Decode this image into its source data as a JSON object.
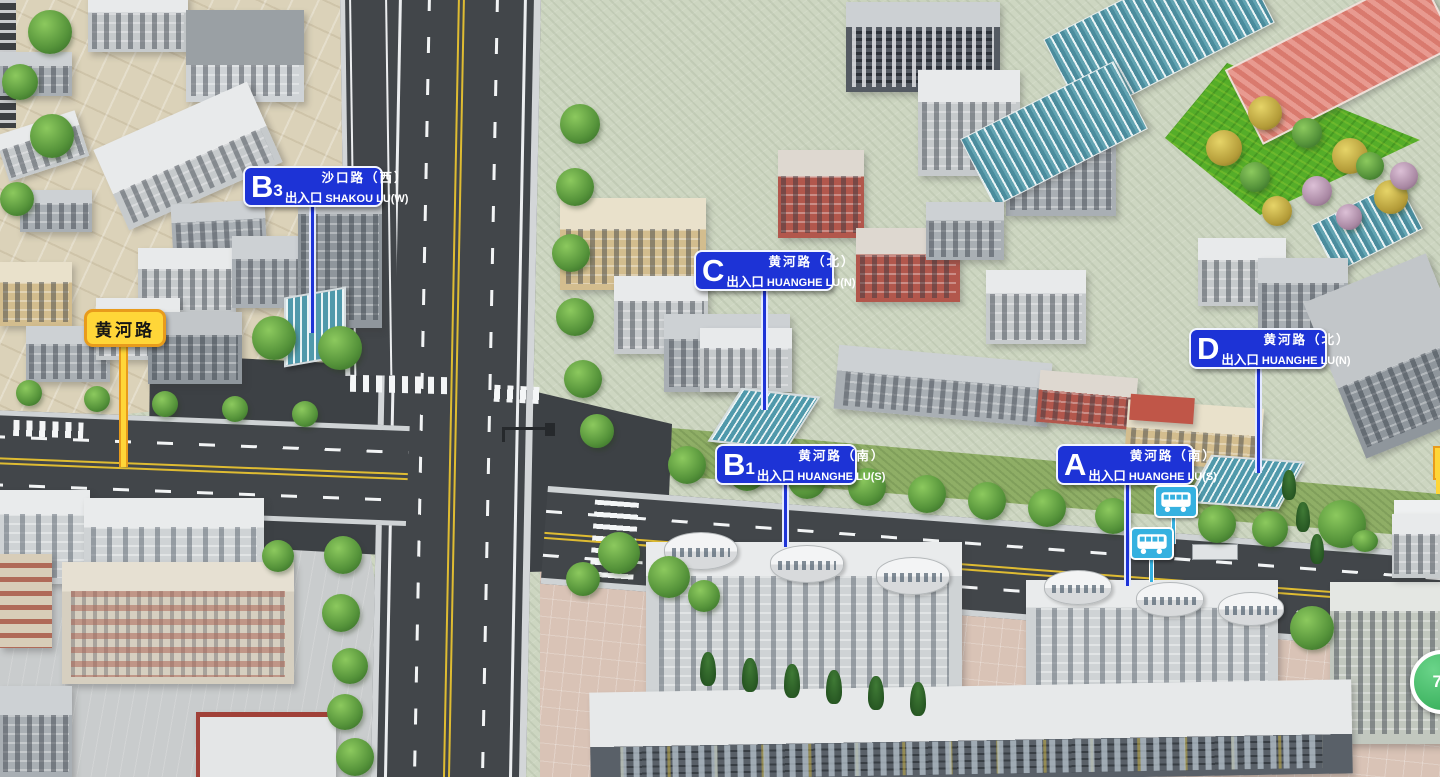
{
  "map_title": "subway-station-exit-3d-map",
  "road_label": {
    "name": "黄河路"
  },
  "exits": [
    {
      "id": "B3",
      "letter": "B",
      "number": "3",
      "road_cn": "沙口路（西）",
      "exit_cn": "出入口",
      "road_en": "SHAKOU LU(W)"
    },
    {
      "id": "C",
      "letter": "C",
      "number": "",
      "road_cn": "黄河路（北）",
      "exit_cn": "出入口",
      "road_en": "HUANGHE LU(N)"
    },
    {
      "id": "D",
      "letter": "D",
      "number": "",
      "road_cn": "黄河路（北）",
      "exit_cn": "出入口",
      "road_en": "HUANGHE LU(N)"
    },
    {
      "id": "B1",
      "letter": "B",
      "number": "1",
      "road_cn": "黄河路（南）",
      "exit_cn": "出入口",
      "road_en": "HUANGHE LU(S)"
    },
    {
      "id": "A",
      "letter": "A",
      "number": "",
      "road_cn": "黄河路（南）",
      "exit_cn": "出入口",
      "road_en": "HUANGHE LU(S)"
    }
  ],
  "bus_route_badge": {
    "label": "73"
  },
  "colors": {
    "exit_sign_blue": "#1d33d6",
    "road_label_yellow": "#ffd638",
    "bus_cyan": "#35b1e0",
    "badge_green": "#3cba62",
    "asphalt": "#42464a",
    "ground_sage": "#cdd6c1"
  }
}
